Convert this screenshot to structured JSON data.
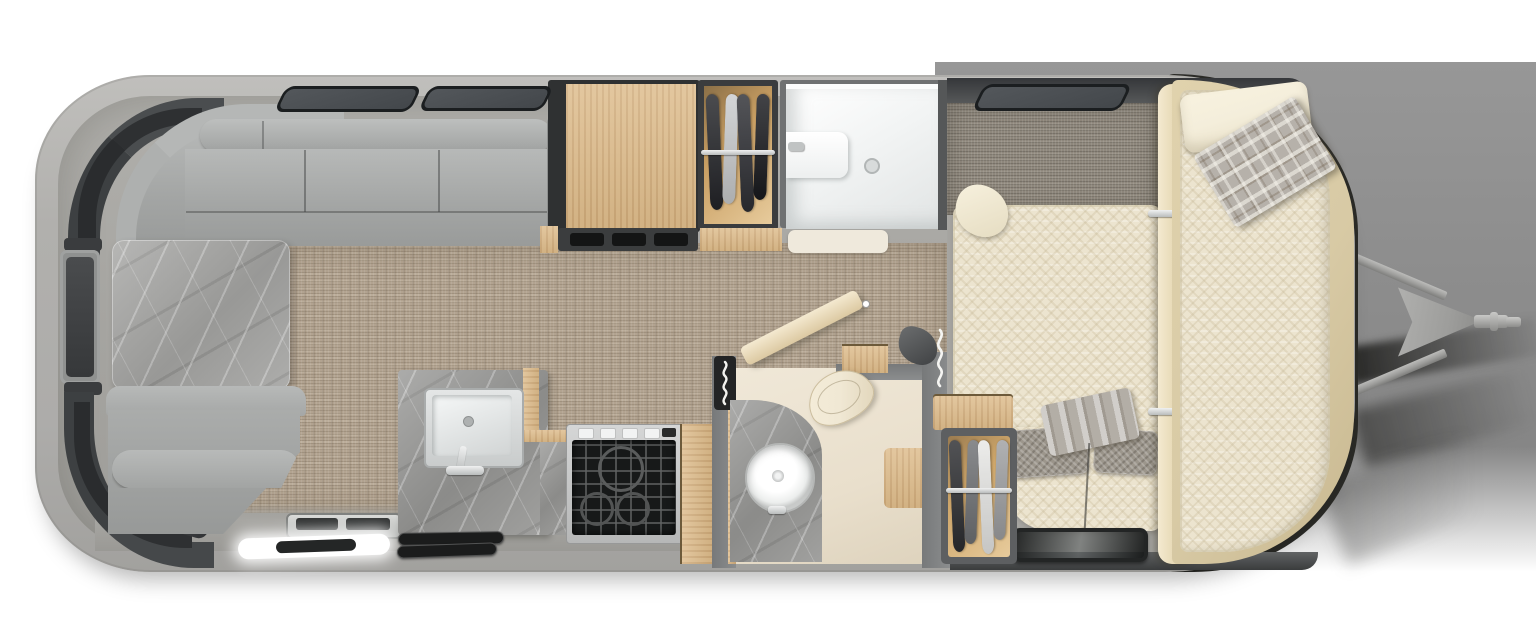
{
  "meta": {
    "figure_kind": "floorplan-top-view",
    "subject": "travel-trailer-interior",
    "has_text": false
  },
  "colors": {
    "page_bg": "#ffffff",
    "backdrop": "#8d8d8d",
    "backdrop_light": "#979797",
    "shell": "#b1b0ad",
    "body_outline": "#2b2b27",
    "floor_gray": "#a7a6a2",
    "carpet_base": "#b2a390",
    "carpet_gray": "#8e877c",
    "cushion": "#a3a5a4",
    "cushion_light": "#b7b9b8",
    "console_dark": "#303234",
    "marble_base": "#a2a2a0",
    "wood_base": "#ddbb8a",
    "wall": "#77797a",
    "vent": "#43474b",
    "mattress": "#ece4cf",
    "pillow": "#f4eedb",
    "plaid": "#b6b1aa",
    "gray_pillow": "#9c968c",
    "cream_frame": "#d8caa5",
    "tan_interior": "#e7cb9c",
    "white_room": "#f6f7f7",
    "appliance_black": "#171919",
    "steel": "#d2d4d4",
    "hitch": "#9d9d9b",
    "led_white": "#ffffff",
    "toilet_cream": "#f0e8d4",
    "bath_floor": "#e9dfcc"
  },
  "wardrobes": {
    "top": {
      "garments": [
        {
          "color": "#232428",
          "h": 116
        },
        {
          "color": "#caccce",
          "h": 110
        },
        {
          "color": "#2e2f34",
          "h": 118
        },
        {
          "color": "#191a1e",
          "h": 106
        }
      ]
    },
    "bedroom": {
      "garments": [
        {
          "color": "#2c2d30",
          "h": 112
        },
        {
          "color": "#6f7174",
          "h": 104
        },
        {
          "color": "#e8e8e6",
          "h": 114
        },
        {
          "color": "#9fa0a2",
          "h": 100
        }
      ]
    }
  }
}
